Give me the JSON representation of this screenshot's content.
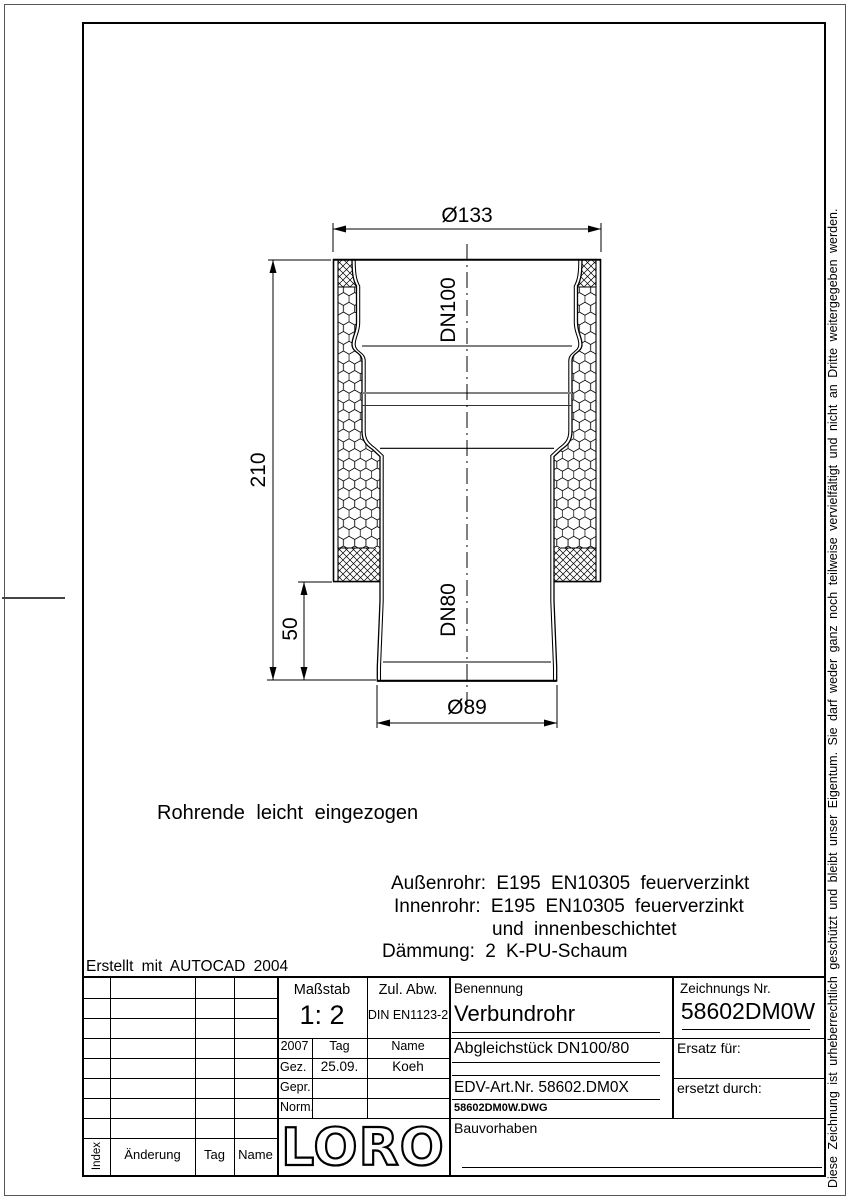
{
  "colors": {
    "line": "#000000",
    "background": "#ffffff",
    "seam_gray": "#808080"
  },
  "drawing": {
    "dim_outer_diameter": "Ø133",
    "dim_total_height": "210",
    "dim_lower_offset": "50",
    "dim_lower_diameter": "Ø89",
    "label_upper": "DN100",
    "label_lower": "DN80",
    "note": "Rohrende leicht eingezogen",
    "material_note_1": "Außenrohr: E195 EN10305 feuerverzinkt",
    "material_note_2": "Innenrohr: E195 EN10305 feuerverzinkt",
    "material_note_3": "und innenbeschichtet",
    "material_note_4": "Dämmung: 2 K-PU-Schaum"
  },
  "created_note": "Erstellt mit AUTOCAD 2004",
  "title_block": {
    "masstab_label": "Maßstab",
    "masstab_value": "1: 2",
    "zul_abw_label": "Zul. Abw.",
    "zul_abw_value": "DIN EN1123-2",
    "benennung_label": "Benennung",
    "benennung_value": "Verbundrohr",
    "zeichnung_label": "Zeichnungs Nr.",
    "zeichnung_value": "58602DM0W",
    "year": "2007",
    "tag_label": "Tag",
    "name_label": "Name",
    "gez_label": "Gez.",
    "gez_date": "25.09.",
    "gez_name": "Koeh",
    "gepr_label": "Gepr.",
    "norm_label": "Norm.",
    "subtitle": "Abgleichstück DN100/80",
    "ersatz_label": "Ersatz für:",
    "edv_art": "EDV-Art.Nr. 58602.DM0X",
    "dwg_file": "58602DM0W.DWG",
    "ersetzt_label": "ersetzt durch:",
    "bauvorhaben_label": "Bauvorhaben",
    "logo": "LORO",
    "index_label": "Index",
    "aenderung_label": "Änderung",
    "tag_col_label": "Tag",
    "name_col_label": "Name"
  },
  "copyright_note": "Diese Zeichnung ist urheberrechtlich geschützt und bleibt unser Eigentum. Sie darf weder ganz noch teilweise vervielfältigt und nicht an Dritte weitergegeben werden."
}
